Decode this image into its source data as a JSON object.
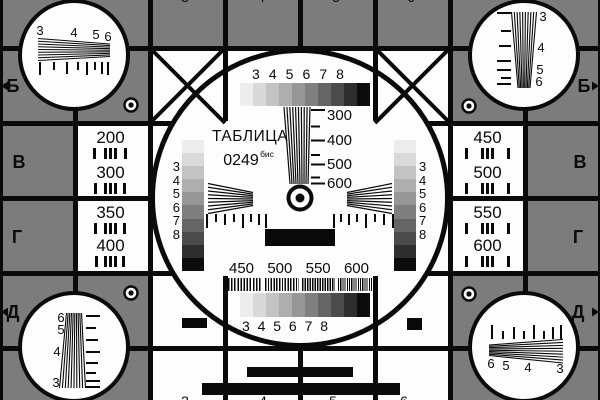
{
  "card": {
    "title": "ТАБЛИЦА",
    "number": "0249",
    "number_suffix": "бис"
  },
  "row_letters": [
    "Б",
    "В",
    "Г",
    "Д"
  ],
  "grayscale_labels": [
    "3",
    "4",
    "5",
    "6",
    "7",
    "8"
  ],
  "corner_wedge_labels": [
    "3",
    "4",
    "5",
    "6"
  ],
  "central_wedge_scale": [
    "300",
    "400",
    "500",
    "600"
  ],
  "frequency_labels": [
    "450",
    "500",
    "550",
    "600"
  ],
  "resolution_left": [
    "200",
    "300",
    "350",
    "400"
  ],
  "resolution_right": [
    "450",
    "500",
    "550",
    "600"
  ],
  "clipped_edge_digits": [
    "3",
    "4",
    "5",
    "6"
  ],
  "colors": {
    "background": "#7c7c7c",
    "foreground": "#0a0a0a",
    "white": "#fdfdfd"
  },
  "grayscale_steps": [
    "#ededed",
    "#d9d9d9",
    "#c3c3c3",
    "#aeaeae",
    "#979797",
    "#7f7f7f",
    "#656565",
    "#4b4b4b",
    "#2e2e2e",
    "#0c0c0c"
  ]
}
